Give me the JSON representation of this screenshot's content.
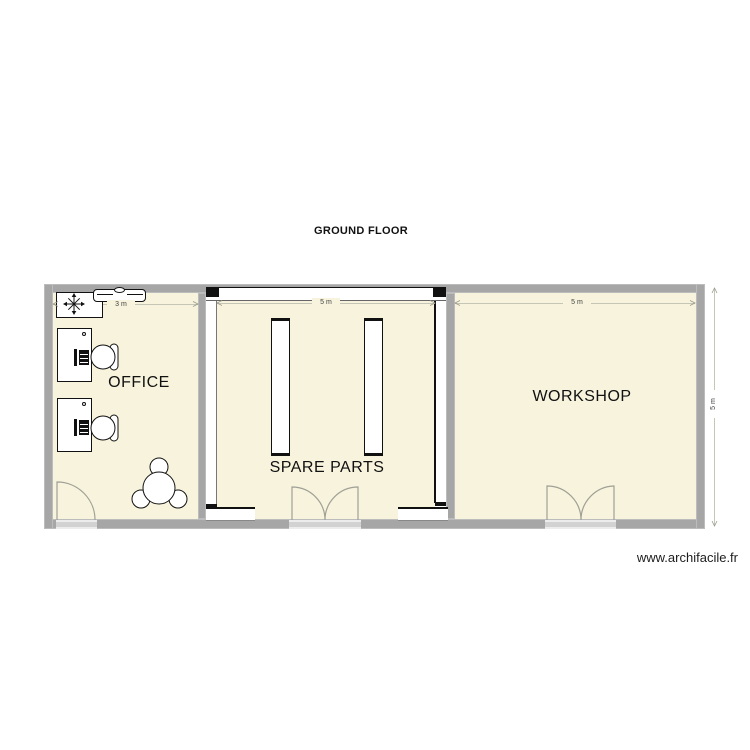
{
  "title": "GROUND FLOOR",
  "watermark": "www.archifacile.fr",
  "rooms": {
    "office": {
      "label": "OFFICE",
      "width": "3 m"
    },
    "spare_parts": {
      "label": "SPARE PARTS",
      "width": "5 m"
    },
    "workshop": {
      "label": "WORKSHOP",
      "width": "5 m"
    }
  },
  "dimensions": {
    "depth": "5 m"
  },
  "colors": {
    "floor": "#f7f3dc",
    "wall": "#a6a6a6",
    "outline": "#111111",
    "door_arc": "#a0a096",
    "dimension_line": "#c6c6b6"
  },
  "furniture": [
    "ac-unit-snowflake",
    "sideboard",
    "desk-with-computer-1",
    "desk-with-computer-2",
    "desk-chair-1",
    "desk-chair-2",
    "round-meeting-table-with-3-chairs",
    "storage-rack-1",
    "storage-rack-2"
  ],
  "openings": [
    "office-single-door",
    "spare-parts-double-door",
    "workshop-double-door",
    "window-top",
    "window-left",
    "window-right",
    "window-bottom-left",
    "window-bottom-right"
  ]
}
